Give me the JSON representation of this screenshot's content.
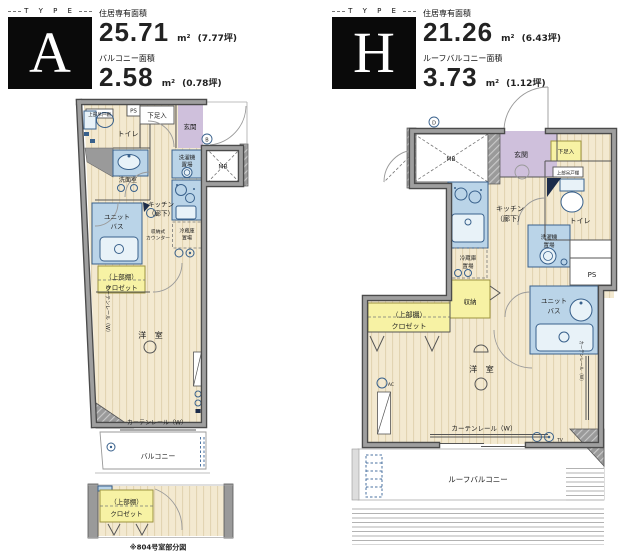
{
  "units": {
    "a": {
      "type_caption": "T Y P E",
      "letter": "A",
      "area_label": "住居専有面積",
      "area_value": "25.71",
      "area_unit": "m²",
      "area_tsubo": "(7.77坪)",
      "balcony_label": "バルコニー面積",
      "balcony_value": "2.58",
      "balcony_unit": "m²",
      "balcony_tsubo": "(0.78坪)"
    },
    "h": {
      "type_caption": "T Y P E",
      "letter": "H",
      "area_label": "住居専有面積",
      "area_value": "21.26",
      "area_unit": "m²",
      "area_tsubo": "(6.43坪)",
      "balcony_label": "ルーフバルコニー面積",
      "balcony_value": "3.73",
      "balcony_unit": "m²",
      "balcony_tsubo": "(1.12坪)"
    }
  },
  "rooms": {
    "toilet": "トイレ",
    "entrance": "玄関",
    "shoe_box": "下足入",
    "ps": "PS",
    "mb": "MB",
    "upper_cabinet": "上部吊戸棚",
    "washer_l1": "洗濯機",
    "washer_l2": "置場",
    "washroom": "洗面室",
    "bath_l1": "ユニット",
    "bath_l2": "バス",
    "kitchen_l1": "キッチン",
    "kitchen_l2": "（廊下）",
    "counter_l1": "収納式",
    "counter_l2": "カウンター",
    "fridge_l1": "冷蔵庫",
    "fridge_l2": "置場",
    "closet_l1": "（上部棚）",
    "closet_l2": "クロゼット",
    "storage": "収納",
    "western_room": "洋 室",
    "curtain_rail": "カーテンレール（W）",
    "balcony": "バルコニー",
    "roof_balcony": "ルーフバルコニー",
    "ac": "AC",
    "tv": "TV",
    "door_mark_b": "B",
    "door_mark_d": "D",
    "caption_804": "※804号室部分図"
  },
  "colors": {
    "floor": "#f3e9d0",
    "floor_stripe": "#e2d4b2",
    "wall": "#9a9a9a",
    "wall_edge": "#4b4b4b",
    "fixture_fill": "#bad4e8",
    "fixture_line": "#39618c",
    "entrance_fill": "#cfc0dc",
    "closet_fill": "#f7f2a4",
    "text": "#222222"
  }
}
